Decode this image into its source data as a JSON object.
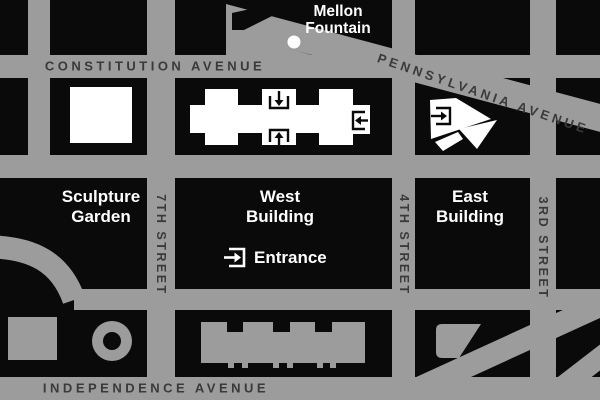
{
  "colors": {
    "street": "#9c9c9c",
    "block": "#0a0a0a",
    "stext": "#3a3a3a",
    "ltext": "#ffffff"
  },
  "streets": {
    "constitution": "CONSTITUTION AVENUE",
    "pennsylvania": "PENNSYLVANIA AVENUE",
    "independence": "INDEPENDENCE AVENUE",
    "seventh": "7TH STREET",
    "fourth": "4TH STREET",
    "third": "3RD STREET"
  },
  "landmarks": {
    "mellon_fountain": {
      "line1": "Mellon",
      "line2": "Fountain"
    },
    "sculpture_garden": {
      "line1": "Sculpture",
      "line2": "Garden"
    },
    "west_building": {
      "line1": "West",
      "line2": "Building"
    },
    "east_building": {
      "line1": "East",
      "line2": "Building"
    },
    "entrance": {
      "label": "Entrance"
    }
  },
  "icons": {
    "entrance_down": "arrow-down-into-bracket",
    "entrance_up": "arrow-up-into-bracket",
    "entrance_left": "arrow-left-into-bracket",
    "entrance_right": "arrow-right-into-bracket",
    "fountain_dot": "white-circle"
  }
}
